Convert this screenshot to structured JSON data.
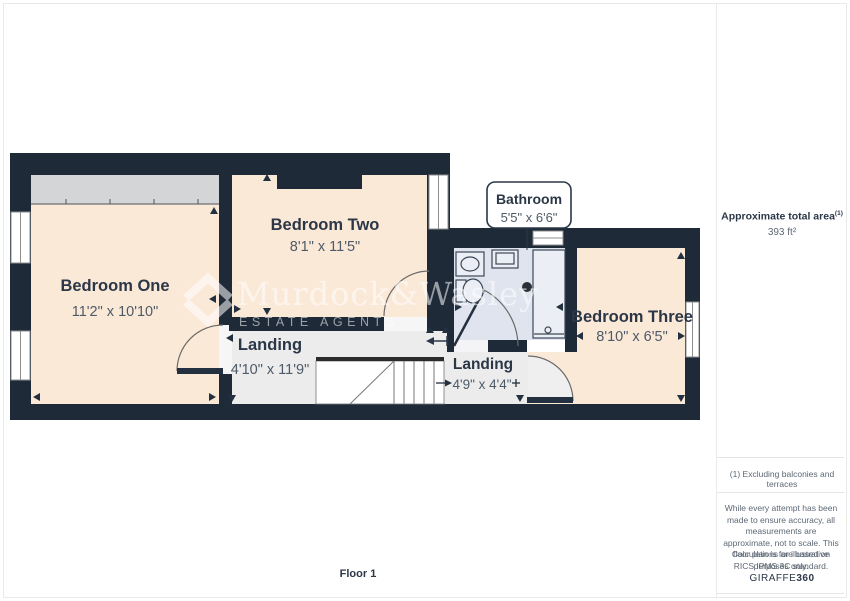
{
  "floorplan": {
    "floor_label": "Floor 1",
    "watermark": {
      "brand": "Murdock&Wasley",
      "tagline": "ESTATE AGENTS"
    },
    "rooms": [
      {
        "name": "Bedroom One",
        "dimensions": "11'2\" x 10'10\""
      },
      {
        "name": "Bedroom Two",
        "dimensions": "8'1\" x 11'5\""
      },
      {
        "name": "Bathroom",
        "dimensions": "5'5\" x 6'6\""
      },
      {
        "name": "Bedroom Three",
        "dimensions": "8'10\" x 6'5\""
      },
      {
        "name": "Landing",
        "dimensions": "4'10\" x 11'9\""
      },
      {
        "name": "Landing",
        "dimensions": "4'9\" x 4'4\""
      }
    ],
    "colors": {
      "wall": "#1f2a39",
      "room_floor": "#fbe9d8",
      "hall_floor": "#ececec",
      "bathroom_floor": "#dfe4ef",
      "label_text": "#2b3747"
    }
  },
  "sidebar": {
    "total_area_label": "Approximate total area",
    "total_area_footnote_marker": "(1)",
    "total_area_value": "393 ft²",
    "footnote": "(1) Excluding balconies and terraces",
    "disclaimer": "While every attempt has been made to ensure accuracy, all measurements are approximate, not to scale. This floor plan is for illustrative purposes only.",
    "standards_note": "Calculations are based on RICS IPMS 3C standard.",
    "brand_name": "GIRAFFE",
    "brand_suffix": "360"
  }
}
